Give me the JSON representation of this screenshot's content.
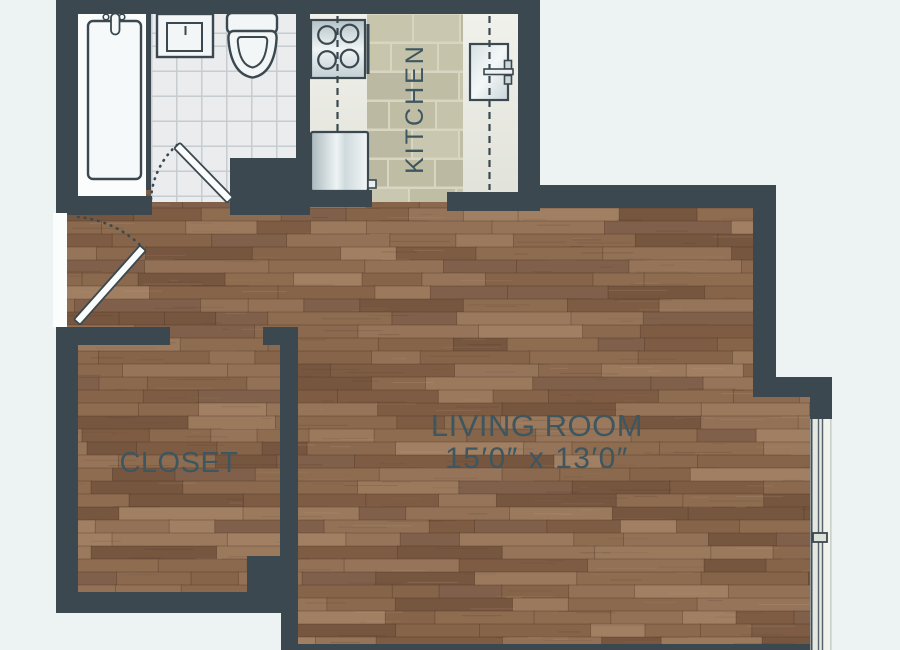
{
  "rooms": {
    "kitchen": {
      "label": "KITCHEN"
    },
    "living_room": {
      "label": "LIVING ROOM",
      "dimensions": "15′0″ x 13′0″"
    },
    "closet": {
      "label": "CLOSET"
    }
  },
  "fixtures": [
    "bathtub",
    "bathtub-faucet",
    "bathroom-sink",
    "toilet",
    "stove",
    "kitchen-sink",
    "refrigerator",
    "entry-door",
    "bathroom-door",
    "closet-opening",
    "window"
  ],
  "colors": {
    "wall": "#3b484f",
    "background": "#edf2f3",
    "white": "#fbfdfd",
    "label_text": "#3e565f",
    "tile": "#eaecee",
    "tile_line": "#c7ccd1",
    "counter": "#e9eae1",
    "window_glass": "#e4e8e0",
    "window_highlight": "#f1f3ed",
    "mortar": "#d8d5c0",
    "wood_palette": [
      "#8d6c50",
      "#856449",
      "#957459",
      "#7d5c43",
      "#8a694e",
      "#927156",
      "#80604a",
      "#9a795d",
      "#775640",
      "#a07f62"
    ],
    "brick_palette": [
      "#c6c3ab",
      "#c0bda5",
      "#cac7b0",
      "#bcb9a2",
      "#c8c5ad"
    ],
    "fixture_outline": "#3b484f",
    "fixture_fill": "#f5f8f9"
  }
}
